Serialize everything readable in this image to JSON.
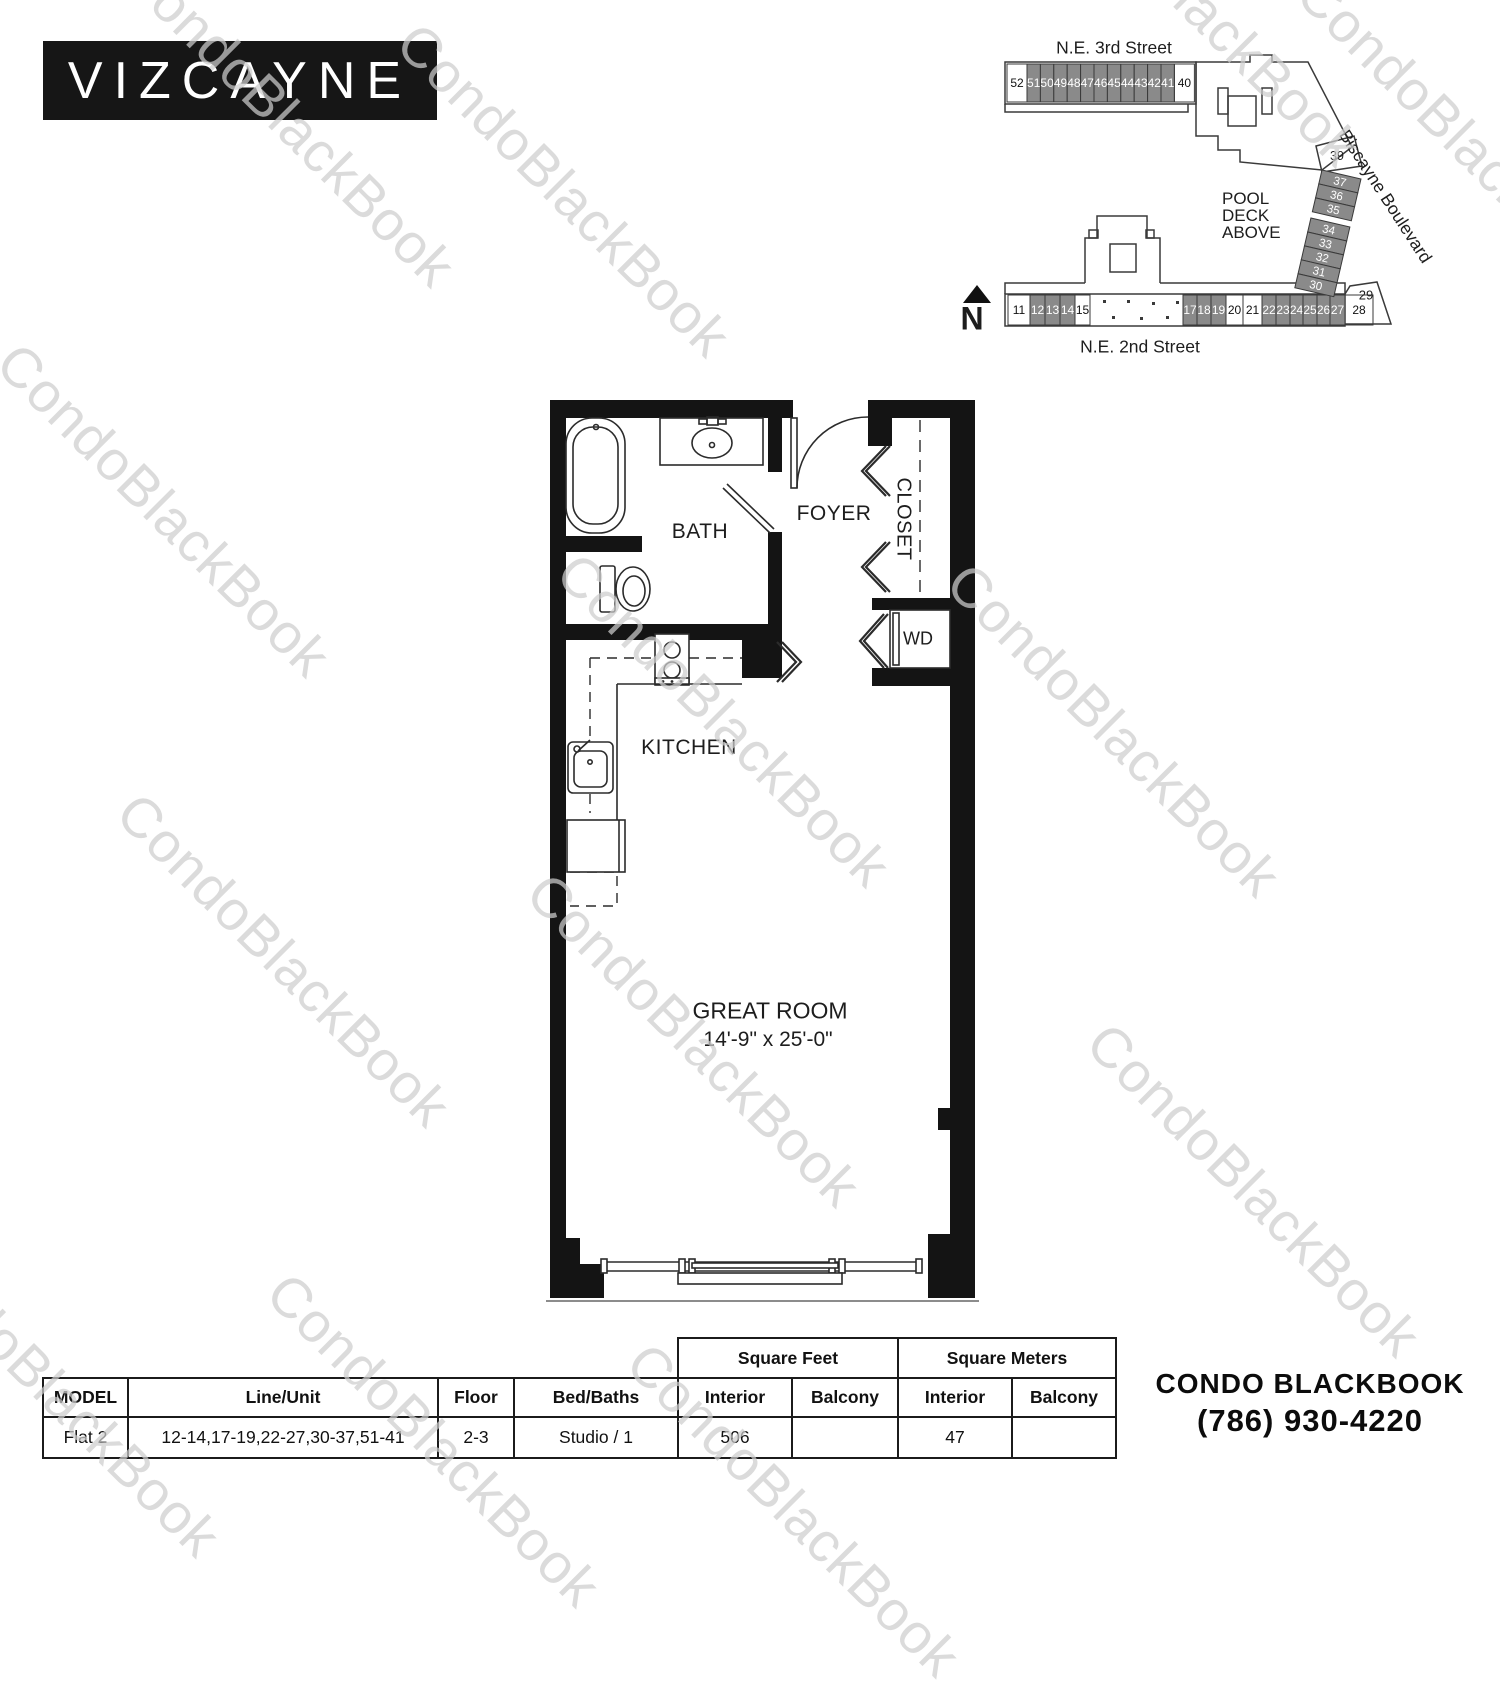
{
  "logo": {
    "text": "VIZCAYNE"
  },
  "watermark": {
    "text": "CondoBlackBook"
  },
  "sitemap": {
    "street_top": "N.E. 3rd Street",
    "street_bottom": "N.E. 2nd Street",
    "street_right": "Biscayne Boulevard",
    "pool_lines": [
      "POOL",
      "DECK",
      "ABOVE"
    ],
    "north_label": "N",
    "top_row": [
      {
        "n": "52",
        "hl": false
      },
      {
        "n": "51",
        "hl": true
      },
      {
        "n": "50",
        "hl": true
      },
      {
        "n": "49",
        "hl": true
      },
      {
        "n": "48",
        "hl": true
      },
      {
        "n": "47",
        "hl": true
      },
      {
        "n": "46",
        "hl": true
      },
      {
        "n": "45",
        "hl": true
      },
      {
        "n": "44",
        "hl": true
      },
      {
        "n": "43",
        "hl": true
      },
      {
        "n": "42",
        "hl": true
      },
      {
        "n": "41",
        "hl": true
      },
      {
        "n": "40",
        "hl": false
      }
    ],
    "right_col": [
      {
        "n": "37",
        "hl": true
      },
      {
        "n": "36",
        "hl": true
      },
      {
        "n": "35",
        "hl": true
      },
      {
        "n": "34",
        "hl": true
      },
      {
        "n": "33",
        "hl": true
      },
      {
        "n": "32",
        "hl": true
      },
      {
        "n": "31",
        "hl": true
      },
      {
        "n": "30",
        "hl": true
      }
    ],
    "bottom_row": [
      {
        "n": "11",
        "hl": false
      },
      {
        "n": "12",
        "hl": true
      },
      {
        "n": "13",
        "hl": true
      },
      {
        "n": "14",
        "hl": true
      },
      {
        "n": "15",
        "hl": false
      },
      {
        "n": "17",
        "hl": true
      },
      {
        "n": "18",
        "hl": true
      },
      {
        "n": "19",
        "hl": true
      },
      {
        "n": "20",
        "hl": false
      },
      {
        "n": "21",
        "hl": false
      },
      {
        "n": "22",
        "hl": true
      },
      {
        "n": "23",
        "hl": true
      },
      {
        "n": "24",
        "hl": true
      },
      {
        "n": "25",
        "hl": true
      },
      {
        "n": "26",
        "hl": true
      },
      {
        "n": "27",
        "hl": true
      },
      {
        "n": "28",
        "hl": false
      }
    ],
    "label_39": "39",
    "label_29": "29",
    "highlight_color": "#8a8a8a"
  },
  "floorplan": {
    "bath": "BATH",
    "foyer": "FOYER",
    "closet": "CLOSET",
    "wd": "WD",
    "kitchen": "KITCHEN",
    "great_room": "GREAT ROOM",
    "great_room_dim": "14'-9\" x 25'-0\""
  },
  "table": {
    "group_headers": [
      "Square Feet",
      "Square Meters"
    ],
    "headers": [
      "MODEL",
      "Line/Unit",
      "Floor",
      "Bed/Baths",
      "Interior",
      "Balcony",
      "Interior",
      "Balcony"
    ],
    "rows": [
      [
        "Flat 2",
        "12-14,17-19,22-27,30-37,51-41",
        "2-3",
        "Studio / 1",
        "506",
        "",
        "47",
        ""
      ]
    ]
  },
  "footer": {
    "brand": "CONDO BLACKBOOK",
    "phone": "(786) 930-4220"
  }
}
